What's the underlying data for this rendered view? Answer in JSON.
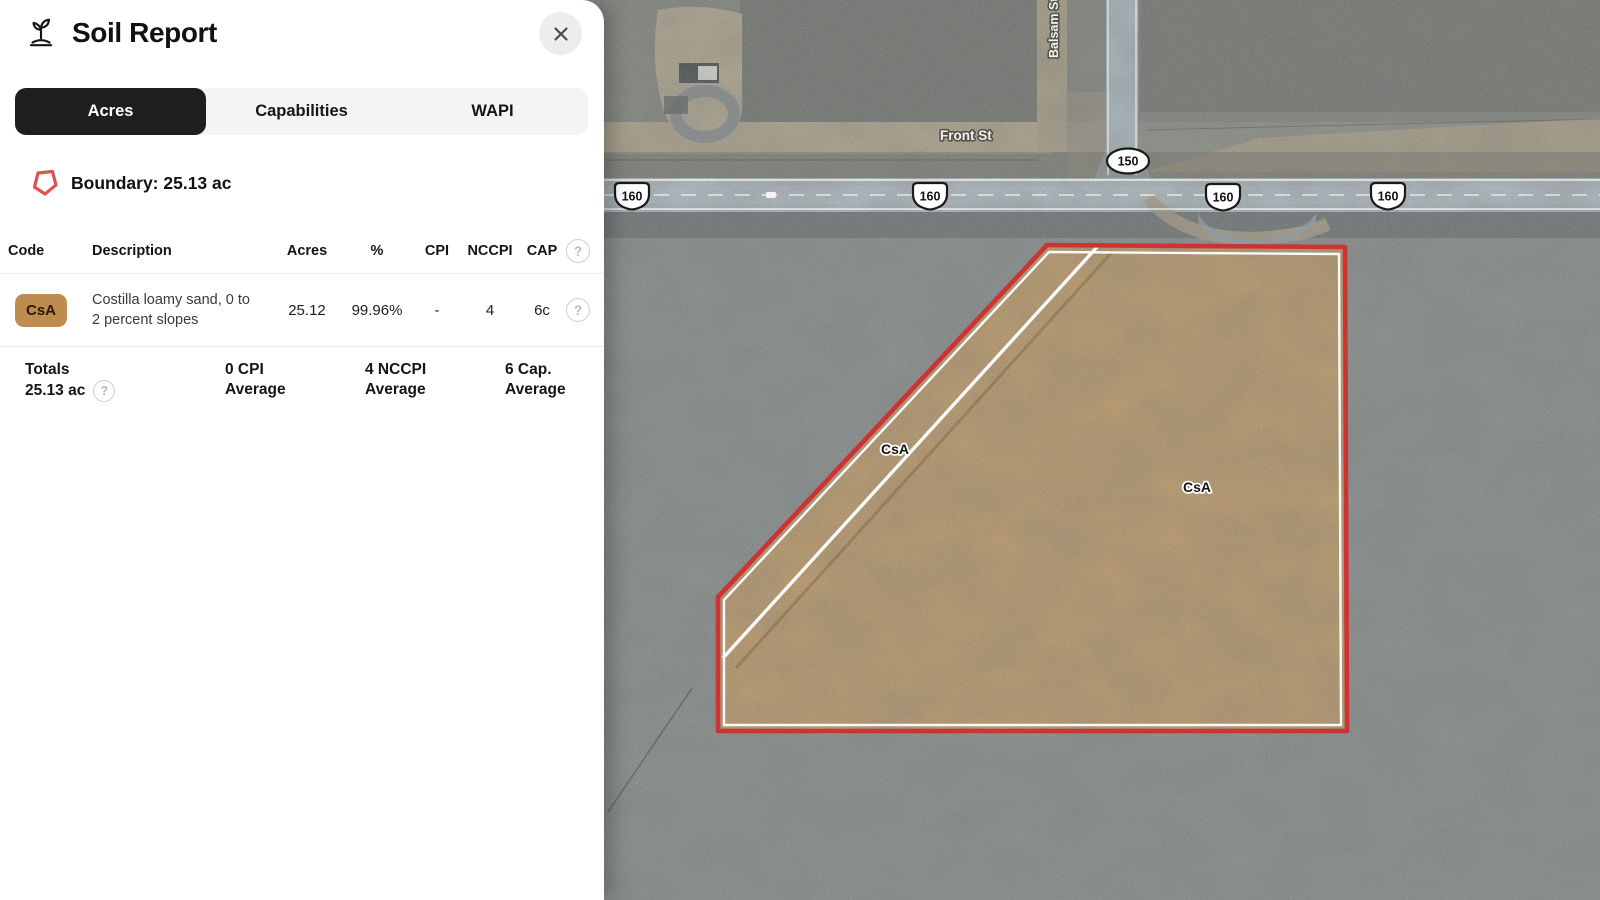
{
  "panel": {
    "title": "Soil Report",
    "tabs": [
      {
        "label": "Acres",
        "active": true
      },
      {
        "label": "Capabilities",
        "active": false
      },
      {
        "label": "WAPI",
        "active": false
      }
    ],
    "boundary_label": "Boundary: 25.13 ac",
    "table": {
      "columns": [
        "Code",
        "Description",
        "Acres",
        "%",
        "CPI",
        "NCCPI",
        "CAP"
      ],
      "rows": [
        {
          "code": "CsA",
          "description": "Costilla loamy sand, 0 to 2 percent slopes",
          "acres": "25.12",
          "percent": "99.96%",
          "cpi": "-",
          "nccpi": "4",
          "cap": "6c"
        }
      ]
    },
    "totals": {
      "label": "Totals",
      "acres": "25.13 ac",
      "items": [
        {
          "value_line": "0 CPI",
          "label_line": "Average"
        },
        {
          "value_line": "4 NCCPI",
          "label_line": "Average"
        },
        {
          "value_line": "6 Cap.",
          "label_line": "Average"
        }
      ]
    },
    "help_glyph": "?"
  },
  "map": {
    "street_labels": {
      "front": "Front St",
      "balsam": "Balsam St"
    },
    "route_shields": [
      "160",
      "160",
      "150",
      "160",
      "160"
    ],
    "soil_labels": [
      "CsA",
      "CsA"
    ]
  },
  "icons": {
    "plant": "plant-icon",
    "close": "close-icon",
    "boundary": "boundary-polygon-icon",
    "help": "help-icon"
  },
  "colors": {
    "tab_active_bg": "#1e1e20",
    "soil_badge_bg": "#bd8c4e",
    "boundary_icon_red": "#e0524e",
    "parcel_fill": "#c99b5d",
    "parcel_stroke": "#ce3333",
    "road_pavement": "#b0bfc9",
    "dirt_tan": "#b3a68c"
  }
}
